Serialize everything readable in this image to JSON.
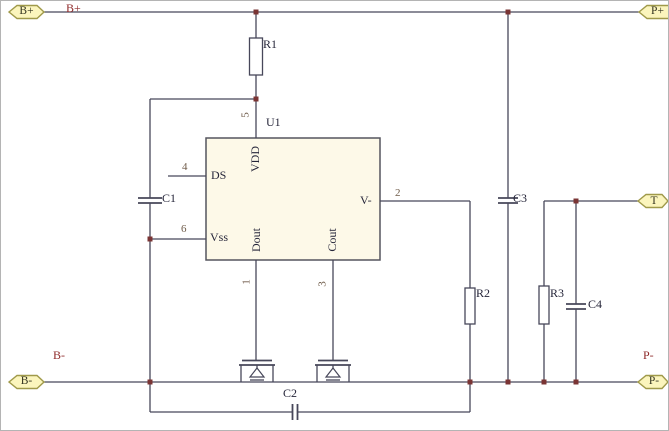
{
  "ports": {
    "bplus": "B+",
    "pplus": "P+",
    "t": "T",
    "bminus": "B-",
    "pminus": "P-"
  },
  "net_labels": {
    "bplus": "B+",
    "bminus": "B-",
    "pminus": "P-"
  },
  "ic": {
    "designator": "U1",
    "pins": {
      "vdd": {
        "number": "5",
        "name": "VDD"
      },
      "ds": {
        "number": "4",
        "name": "DS"
      },
      "vss": {
        "number": "6",
        "name": "Vss"
      },
      "dout": {
        "number": "1",
        "name": "Dout"
      },
      "cout": {
        "number": "3",
        "name": "Cout"
      },
      "vminus": {
        "number": "2",
        "name": "V-"
      }
    }
  },
  "components": {
    "r1": "R1",
    "r2": "R2",
    "r3": "R3",
    "c1": "C1",
    "c2": "C2",
    "c3": "C3",
    "c4": "C4"
  },
  "colors": {
    "wire": "#47475a",
    "ic_border": "#55555f",
    "ic_fill": "#fdf9e8",
    "junction": "#7a3434",
    "net_label": "#8f2b2b",
    "pin_number": "#6e5a48",
    "text": "#26263a",
    "port_fill": "#fbf5bd",
    "port_border": "#a09a4a"
  }
}
